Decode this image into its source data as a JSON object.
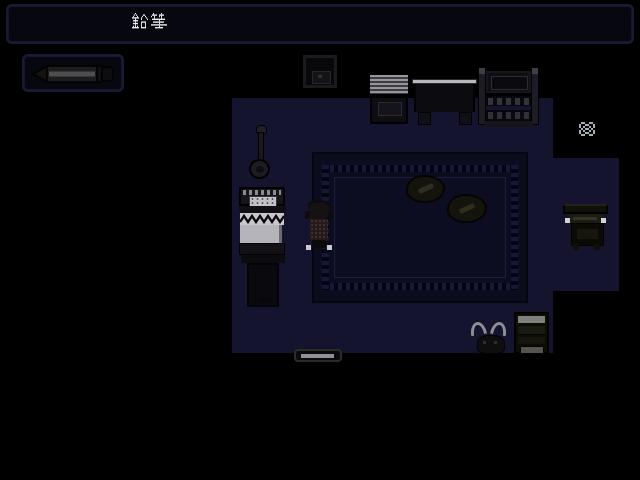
{
  "hud": {
    "message_window": {
      "text": "鉛筆"
    },
    "item_window": {
      "item_name": "鉛筆",
      "icon": "pencil-icon"
    }
  },
  "scene": {
    "room": "dark-bedroom-top-down",
    "objects": [
      "wall-frame",
      "dresser",
      "table",
      "shelf-unit",
      "sparkle",
      "floor-lamp",
      "bed",
      "player-character",
      "rug",
      "cushion-left",
      "cushion-right",
      "desk-chair",
      "cat",
      "book-stack",
      "door-mat"
    ],
    "colors": {
      "background": "#000000",
      "floor": "#14142f",
      "rug_border": "#0c0c1f",
      "rug_field": "#0d0d22",
      "bed_sheet": "#b8b8be",
      "text": "#e9e9ef",
      "sparkle": "#a8adb5",
      "highlight_gray": "#8e8e96"
    }
  }
}
